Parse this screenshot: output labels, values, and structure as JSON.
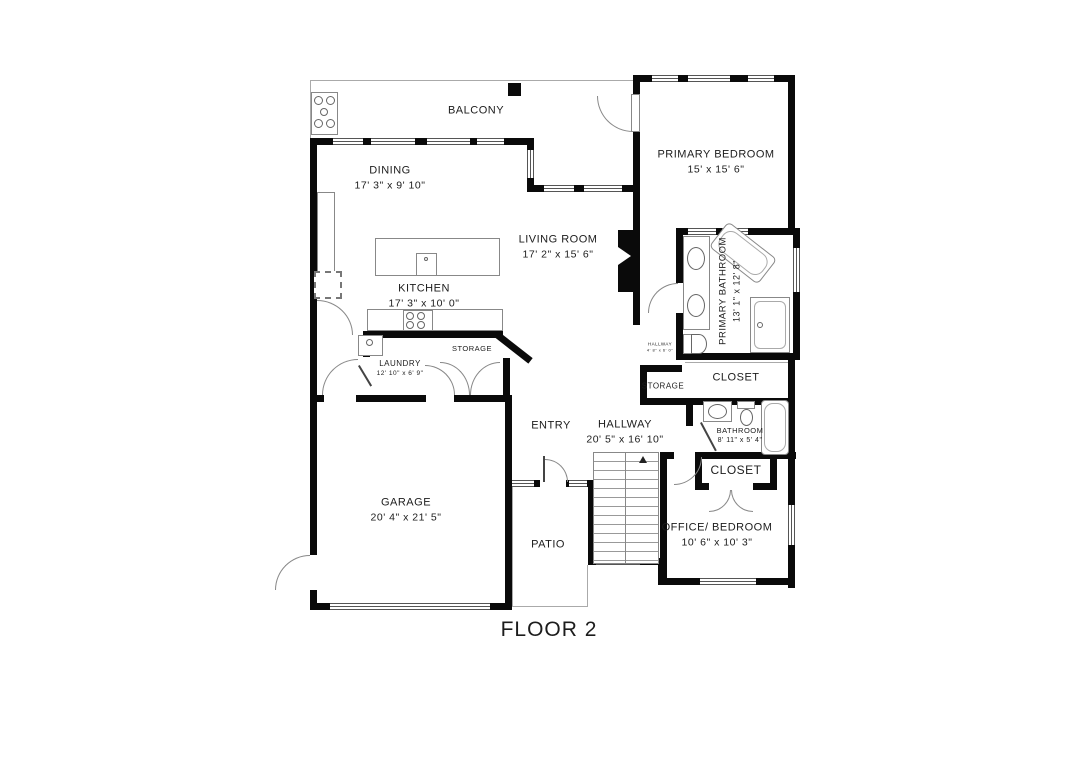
{
  "title": "FLOOR 2",
  "colors": {
    "wall": "#0a0a0a",
    "text": "#1c1c1c"
  },
  "rooms": {
    "balcony": {
      "name": "BALCONY"
    },
    "dining": {
      "name": "DINING",
      "dims": "17' 3\" x 9' 10\""
    },
    "primary_bedroom": {
      "name": "PRIMARY BEDROOM",
      "dims": "15' x 15' 6\""
    },
    "living_room": {
      "name": "LIVING ROOM",
      "dims": "17' 2\" x 15' 6\""
    },
    "kitchen": {
      "name": "KITCHEN",
      "dims": "17' 3\" x 10' 0\""
    },
    "laundry": {
      "name": "LAUNDRY",
      "dims": "12' 10\" x 6' 9\""
    },
    "storage_kitchen": {
      "name": "STORAGE"
    },
    "primary_bathroom": {
      "name": "PRIMARY BATHROOM",
      "dims": "13' 1\" x 12' 8\""
    },
    "hallway_upper": {
      "name": "HALLWAY",
      "dims": "4' 8\" x 6' 0\""
    },
    "storage_hall": {
      "name": "STORAGE"
    },
    "closet_primary": {
      "name": "CLOSET"
    },
    "bathroom": {
      "name": "BATHROOM",
      "dims": "8' 11\" x 5' 4\""
    },
    "closet_office": {
      "name": "CLOSET"
    },
    "office_bedroom": {
      "name": "OFFICE/ BEDROOM",
      "dims": "10' 6\" x 10' 3\""
    },
    "hallway": {
      "name": "HALLWAY",
      "dims": "20' 5\" x 16' 10\""
    },
    "entry": {
      "name": "ENTRY"
    },
    "garage": {
      "name": "GARAGE",
      "dims": "20' 4\" x 21' 5\""
    },
    "patio": {
      "name": "PATIO"
    }
  }
}
